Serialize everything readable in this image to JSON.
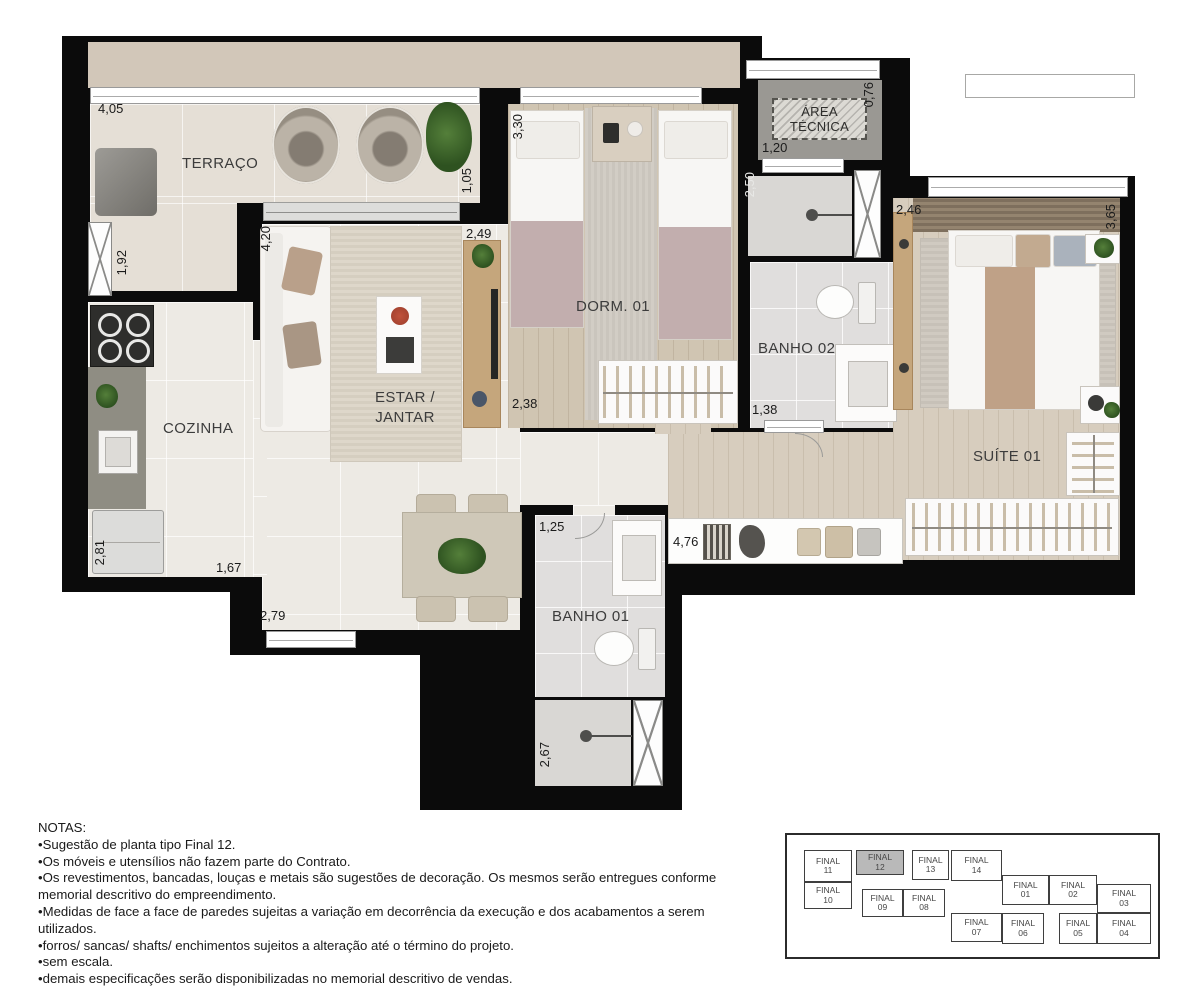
{
  "plan": {
    "rooms": {
      "terraco": "TERRAÇO",
      "cozinha": "COZINHA",
      "estar_line1": "ESTAR /",
      "estar_line2": "JANTAR",
      "dorm01": "DORM. 01",
      "banho01": "BANHO 01",
      "banho02": "BANHO 02",
      "suite01": "SUÍTE 01",
      "area_tecnica_line1": "ÁREA",
      "area_tecnica_line2": "TÉCNICA"
    },
    "dimensions": {
      "terraco_width": "4,05",
      "terraco_left": "1,92",
      "terraco_right": "1,05",
      "estar_height": "4,20",
      "estar_top": "2,49",
      "dorm_height": "3,30",
      "dorm_width": "2,38",
      "area_tecnica_depth": "0,76",
      "area_tecnica_width": "1,20",
      "banho02_height": "2,50",
      "banho02_width": "1,38",
      "suite_top": "2,46",
      "suite_right": "3,65",
      "cozinha_height": "2,81",
      "cozinha_width": "1,67",
      "estar_bottom": "2,79",
      "banho01_width": "1,25",
      "hall_width": "4,76",
      "banho01_shower_height": "2,67"
    },
    "colors": {
      "wall": "#0b0b0b",
      "slab": "#d2c7b9",
      "terrace_floor": "#e5dfd6",
      "tile_floor": "#edeae4",
      "wood_floor": "#d0c5b2",
      "bath_floor": "#e0dedd",
      "counter_grey": "#8f8d83",
      "blanket_mauve": "#c2aeae",
      "throw_tan": "#bfa187",
      "keyplan_highlight": "#b9b9b9"
    }
  },
  "notes": {
    "lines": [
      "NOTAS:",
      "•Sugestão de planta tipo Final 12.",
      "•Os móveis e utensílios não fazem parte do Contrato.",
      "•Os revestimentos, bancadas, louças e metais são sugestões de decoração. Os mesmos serão entregues conforme",
      "memorial descritivo do empreendimento.",
      "•Medidas de face a face de paredes sujeitas a variação em decorrência da execução e dos acabamentos a serem utilizados.",
      "•forros/ sancas/ shafts/ enchimentos sujeitos a alteração até o término do projeto.",
      "•sem escala.",
      "•demais especificações serão disponibilizadas no memorial descritivo de vendas."
    ]
  },
  "keyplan": {
    "highlighted": "FINAL 12",
    "units": [
      {
        "line1": "FINAL",
        "line2": "11",
        "highlighted": false
      },
      {
        "line1": "FINAL",
        "line2": "12",
        "highlighted": true
      },
      {
        "line1": "FINAL",
        "line2": "13",
        "highlighted": false
      },
      {
        "line1": "FINAL",
        "line2": "14",
        "highlighted": false
      },
      {
        "line1": "FINAL",
        "line2": "10",
        "highlighted": false
      },
      {
        "line1": "FINAL",
        "line2": "09",
        "highlighted": false
      },
      {
        "line1": "FINAL",
        "line2": "08",
        "highlighted": false
      },
      {
        "line1": "FINAL",
        "line2": "01",
        "highlighted": false
      },
      {
        "line1": "FINAL",
        "line2": "02",
        "highlighted": false
      },
      {
        "line1": "FINAL",
        "line2": "03",
        "highlighted": false
      },
      {
        "line1": "FINAL",
        "line2": "07",
        "highlighted": false
      },
      {
        "line1": "FINAL",
        "line2": "06",
        "highlighted": false
      },
      {
        "line1": "FINAL",
        "line2": "05",
        "highlighted": false
      },
      {
        "line1": "FINAL",
        "line2": "04",
        "highlighted": false
      }
    ]
  }
}
